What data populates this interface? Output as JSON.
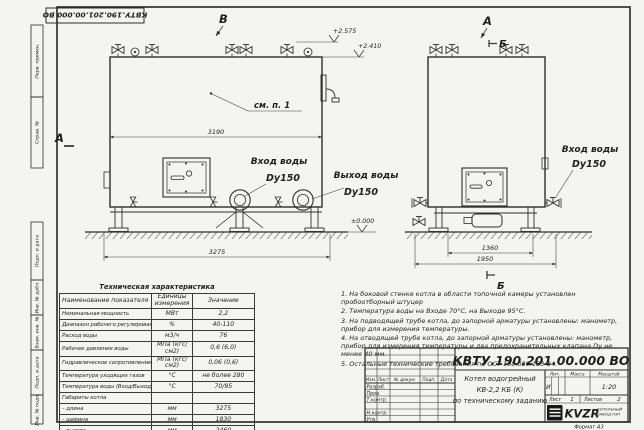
{
  "sheet": {
    "doc_number_top": "КВТУ.190.201.00.000 ВО"
  },
  "margin": {
    "fields": [
      "Перв. примен.",
      "Справ. №",
      "Подп. и дата",
      "Инв. № дубл.",
      "Взам. инв. №",
      "Подп. и дата",
      "Инв. № подл."
    ]
  },
  "views": {
    "front": {
      "label_top": "В",
      "label_left": "А",
      "callout": "см. п. 1",
      "dim_body": "3190",
      "dim_overall": "3275",
      "elev_1": "+2.575",
      "elev_2": "+2.410",
      "elev_ground": "±0.000",
      "inlet_label": "Вход воды",
      "inlet_dn": "Dy150",
      "outlet_label": "Выход воды",
      "outlet_dn": "Dy150"
    },
    "side": {
      "label_top": "А",
      "label_section_top": "Б",
      "label_section_bottom": "Б",
      "dim_inner": "1360",
      "dim_overall": "1950",
      "inlet_label": "Вход воды",
      "inlet_dn": "Dy150"
    }
  },
  "spec_table": {
    "title": "Техническая характеристика",
    "headers": [
      "Наименование показателя",
      "Единицы измерения",
      "Значение"
    ],
    "rows": [
      [
        "Номинальная мощность",
        "МВт",
        "2,2"
      ],
      [
        "Диапазон рабочего регулирования",
        "%",
        "40-110"
      ],
      [
        "Расход воды",
        "м3/ч",
        "76"
      ],
      [
        "Рабочее давление воды",
        "МПа (кгс/см2)",
        "0,6 (6,0)"
      ],
      [
        "Гидравлическое сопротивление котла",
        "МПа (кгс/см2)",
        "0,06 (0,6)"
      ],
      [
        "Температура уходящих газов",
        "°С",
        "не более 280"
      ],
      [
        "Температура воды (Вход/Выход)",
        "°С",
        "70/95"
      ],
      [
        "Габариты котла",
        "",
        ""
      ],
      [
        "– длина",
        "мм",
        "3275"
      ],
      [
        "– ширина",
        "мм",
        "1830"
      ],
      [
        "– высота",
        "мм",
        "2460"
      ]
    ]
  },
  "notes": {
    "items": [
      "1.  На боковой стенке котла в области топочной камеры установлен пробоотборный штуцер",
      "2.  Температура воды на Входе 70°С, на Выходе 95°С.",
      "3.  На подводящей трубе котла, до запорной арматуры установлены: манометр, прибор для измерения температуры.",
      "4.  На отводящей трубе котла, до запорной арматуры установлены: манометр, прибор для измерения температуры и два предохранительных клапана Dу не менее 40 мм.",
      "5.  Остальные технические требования по ОСТ 108.030.133-84."
    ]
  },
  "stamp": {
    "doc_number": "КВТУ.190.201.00.000  ВО",
    "rev_headers": [
      "Изм.",
      "Лист",
      "№ докум.",
      "Подп.",
      "Дата"
    ],
    "row_labels": [
      "Разраб.",
      "Пров.",
      "Т.контр.",
      "Н.контр.",
      "Утв."
    ],
    "title_line1": "Котел водогрейный",
    "title_line2": "КВ-2,2 КБ (К)",
    "title_line3": "по техническому заданию",
    "lit_headers": [
      "Лит.",
      "Масса",
      "Масштаб"
    ],
    "lit_value": "И",
    "scale_value": "1:20",
    "sheet_label": "Лист",
    "sheet_value": "1",
    "sheets_label": "Листов",
    "sheets_value": "2",
    "logo_text": "KVZR",
    "logo_caption_1": "КОТЕЛЬНЫЙ",
    "logo_caption_2": "ЗАВОД РЭП",
    "format_label": "Формат  А3"
  }
}
